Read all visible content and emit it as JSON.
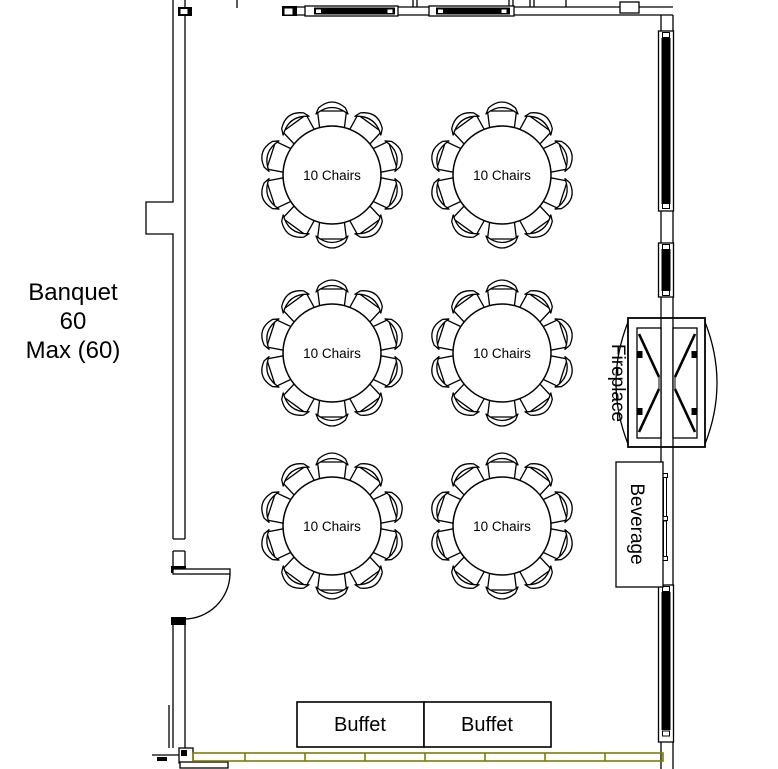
{
  "room": {
    "label_line1": "Banquet",
    "label_line2": "60",
    "label_line3": "Max (60)",
    "capacity": 60,
    "max_capacity": 60
  },
  "tables": [
    {
      "label": "10 Chairs",
      "seats": 10
    },
    {
      "label": "10 Chairs",
      "seats": 10
    },
    {
      "label": "10 Chairs",
      "seats": 10
    },
    {
      "label": "10 Chairs",
      "seats": 10
    },
    {
      "label": "10 Chairs",
      "seats": 10
    },
    {
      "label": "10 Chairs",
      "seats": 10
    }
  ],
  "fixtures": {
    "fireplace_label": "Fireplace",
    "beverage_label": "Beverage",
    "buffets": [
      {
        "label": "Buffet"
      },
      {
        "label": "Buffet"
      }
    ]
  },
  "colors": {
    "line": "#000000",
    "air_wall_divider": "#7f7f00",
    "window_fill": "#000000",
    "background": "#ffffff",
    "text": "#000000"
  }
}
